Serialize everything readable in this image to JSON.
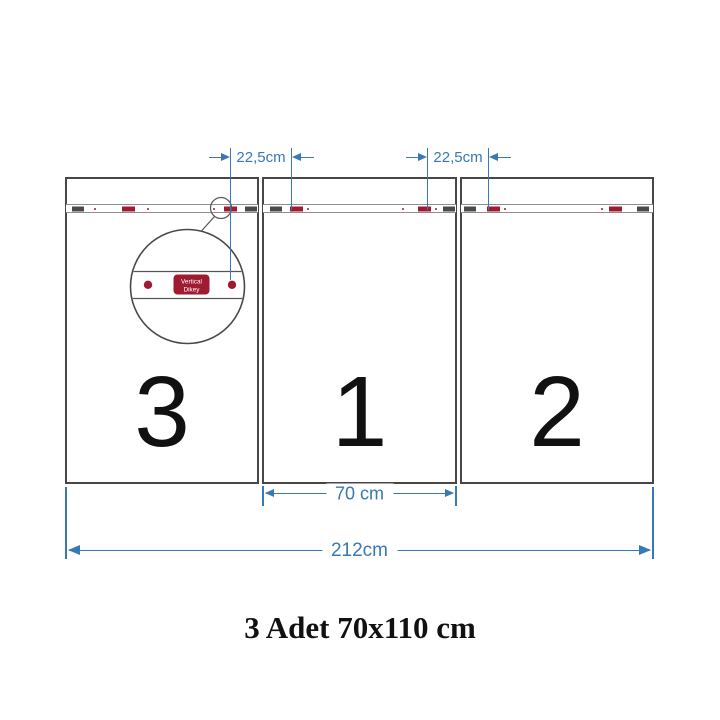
{
  "product_diagram": {
    "caption": "3 Adet 70x110 cm",
    "panels": [
      {
        "number": "3"
      },
      {
        "number": "1"
      },
      {
        "number": "2"
      }
    ],
    "dimensions": {
      "hanger_spacing_left": "22,5cm",
      "hanger_spacing_right": "22,5cm",
      "panel_width": "70 cm",
      "total_width": "212cm"
    },
    "magnifier_detail": {
      "label_line1": "Vertical",
      "label_line2": "Dikey"
    },
    "colors": {
      "dimension_blue": "#3878B4",
      "hanger_red": "#9E1B30",
      "panel_border": "#474747"
    }
  }
}
